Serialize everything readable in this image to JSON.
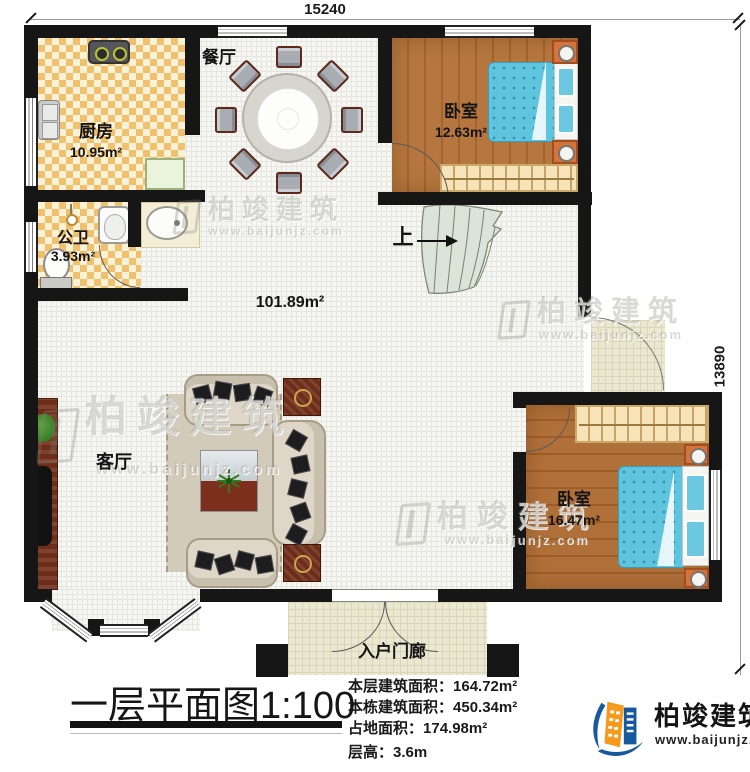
{
  "dimensions": {
    "top": "15240",
    "right": "13890"
  },
  "rooms": {
    "kitchen": {
      "name": "厨房",
      "area": "10.95m²"
    },
    "dining": {
      "name": "餐厅"
    },
    "bedroom_top": {
      "name": "卧室",
      "area": "12.63m²"
    },
    "bathroom": {
      "name": "公卫",
      "area": "3.93m²"
    },
    "hall": {
      "area": "101.89m²"
    },
    "living": {
      "name": "客厅"
    },
    "bedroom_right": {
      "name": "卧室",
      "area": "16.47m²"
    },
    "porch": {
      "name": "入户门廊"
    },
    "stairs": {
      "up_label": "上"
    }
  },
  "title": {
    "text": "一层平面图",
    "scale": "1:100"
  },
  "stats": {
    "lines": [
      {
        "label": "本层建筑面积：",
        "value": "164.72m²"
      },
      {
        "label": "本栋建筑面积：",
        "value": "450.34m²"
      },
      {
        "label": "占地面积：",
        "value": "174.98m²"
      },
      {
        "label": "层高：",
        "value": "3.6m"
      }
    ]
  },
  "brand": {
    "name": "柏竣建筑",
    "url": "www.baijunjz.com"
  },
  "watermark": {
    "name": "柏竣建筑",
    "url": "www.baijunjz.com"
  },
  "colors": {
    "wall": "#161616",
    "wood_floor": "#b5773f",
    "checker_tile": "#efc06e",
    "bed": "#5fc4de",
    "brand_blue": "#17599f",
    "brand_orange": "#f59a1d"
  }
}
